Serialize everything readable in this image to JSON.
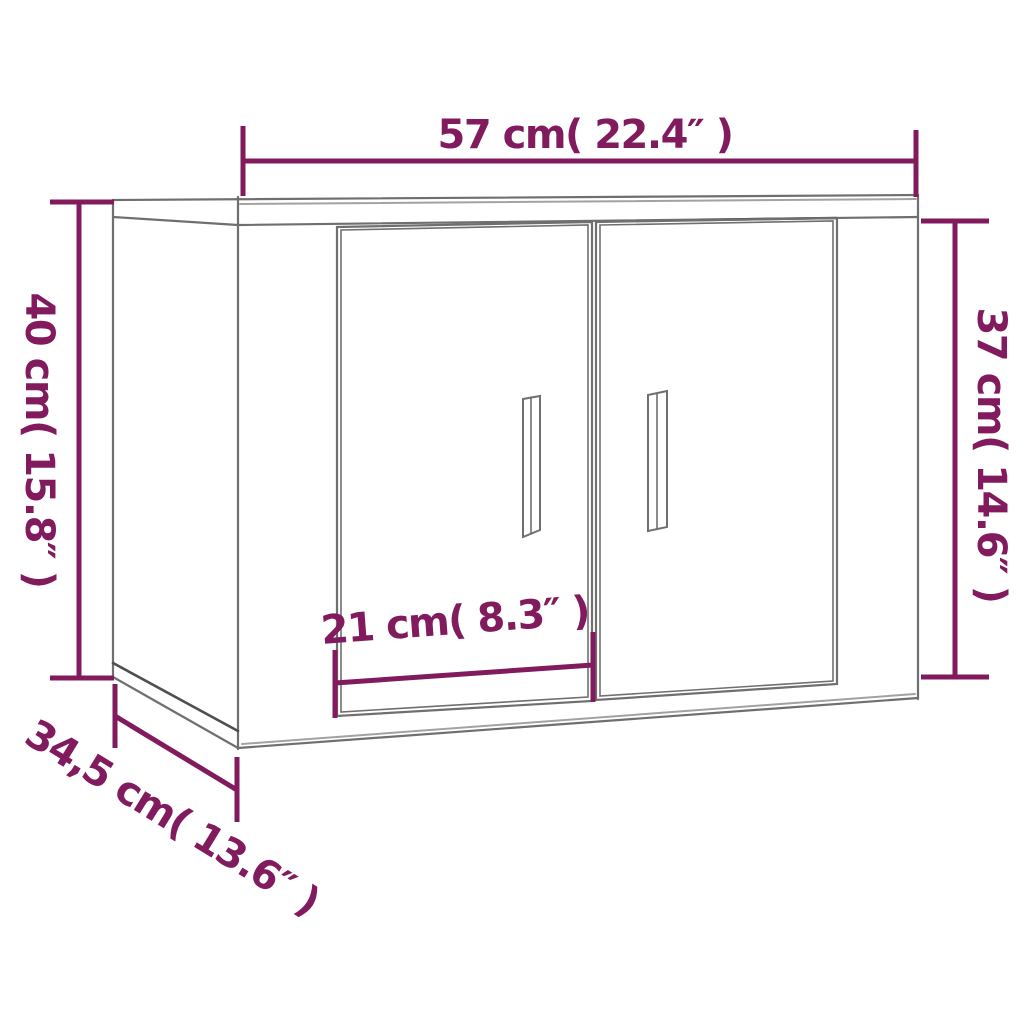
{
  "diagram": {
    "accent_color": "#811B5E",
    "outline_color": "#6f6f6f",
    "outline_light_color": "#a2a2a2",
    "outline_dark_color": "#4f4f4f",
    "background_color": "#ffffff",
    "dimensions": {
      "width": {
        "label": "57 cm( 22.4″ )",
        "cm": "57",
        "inches": "22.4"
      },
      "height_left": {
        "label": "40 cm( 15.8″ )",
        "cm": "40",
        "inches": "15.8"
      },
      "height_right": {
        "label": "37 cm( 14.6″ )",
        "cm": "37",
        "inches": "14.6"
      },
      "door_width": {
        "label": "21 cm( 8.3″ )",
        "cm": "21",
        "inches": "8.3"
      },
      "depth": {
        "label": "34,5 cm( 13.6″ )",
        "cm": "34,5",
        "inches": "13.6"
      }
    }
  }
}
